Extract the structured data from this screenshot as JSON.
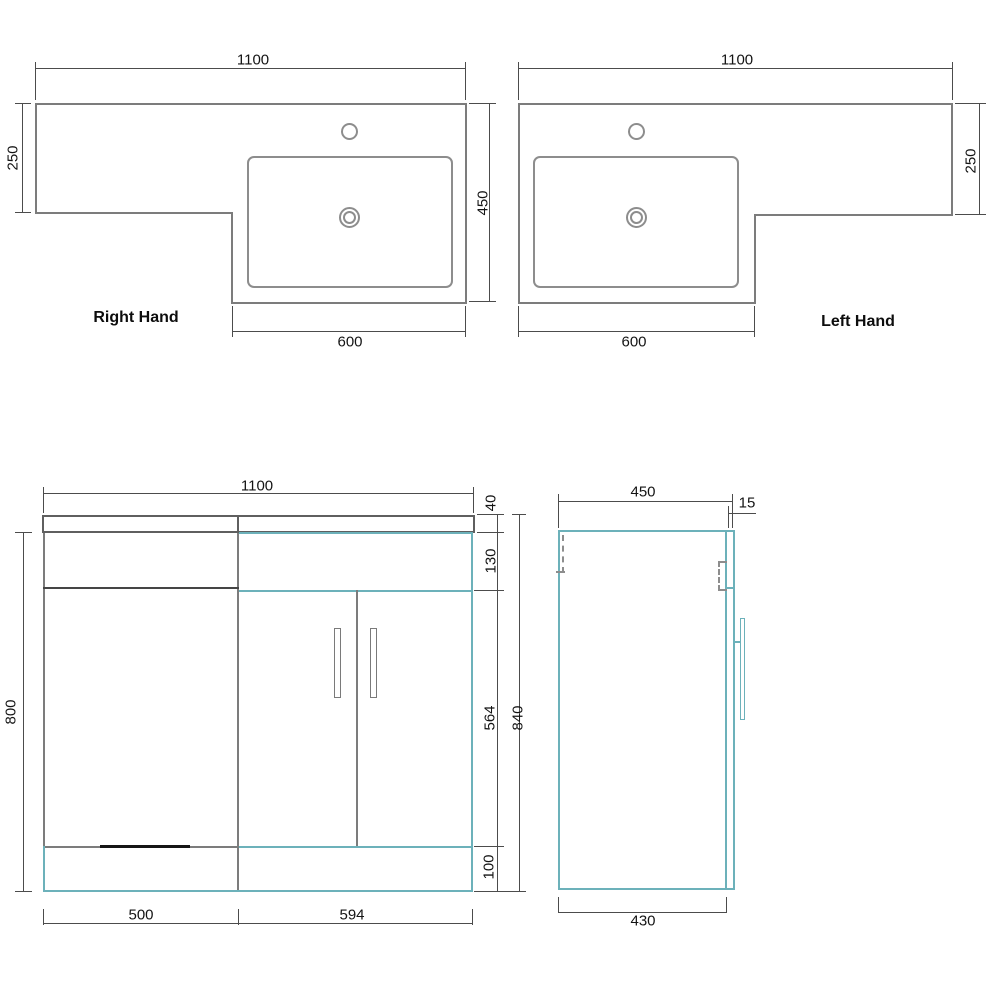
{
  "right_hand_view": {
    "label": "Right Hand",
    "overall_width": "1100",
    "worktop_depth": "250",
    "basin_depth": "450",
    "basin_unit_width": "600"
  },
  "left_hand_view": {
    "label": "Left Hand",
    "overall_width": "1100",
    "worktop_depth": "250",
    "basin_unit_width": "600"
  },
  "front_view": {
    "overall_width": "1100",
    "worktop_thickness": "40",
    "upper_panel_height": "130",
    "door_height": "564",
    "plinth_height": "100",
    "carcass_height": "800",
    "overall_height": "840",
    "left_section_width": "500",
    "door_section_width": "594"
  },
  "side_view": {
    "overall_depth": "450",
    "door_thickness": "15",
    "carcass_depth": "430"
  },
  "colors": {
    "carcass_accent": "#6cb1ba",
    "outline": "#7c7c7c",
    "text": "#141414"
  }
}
